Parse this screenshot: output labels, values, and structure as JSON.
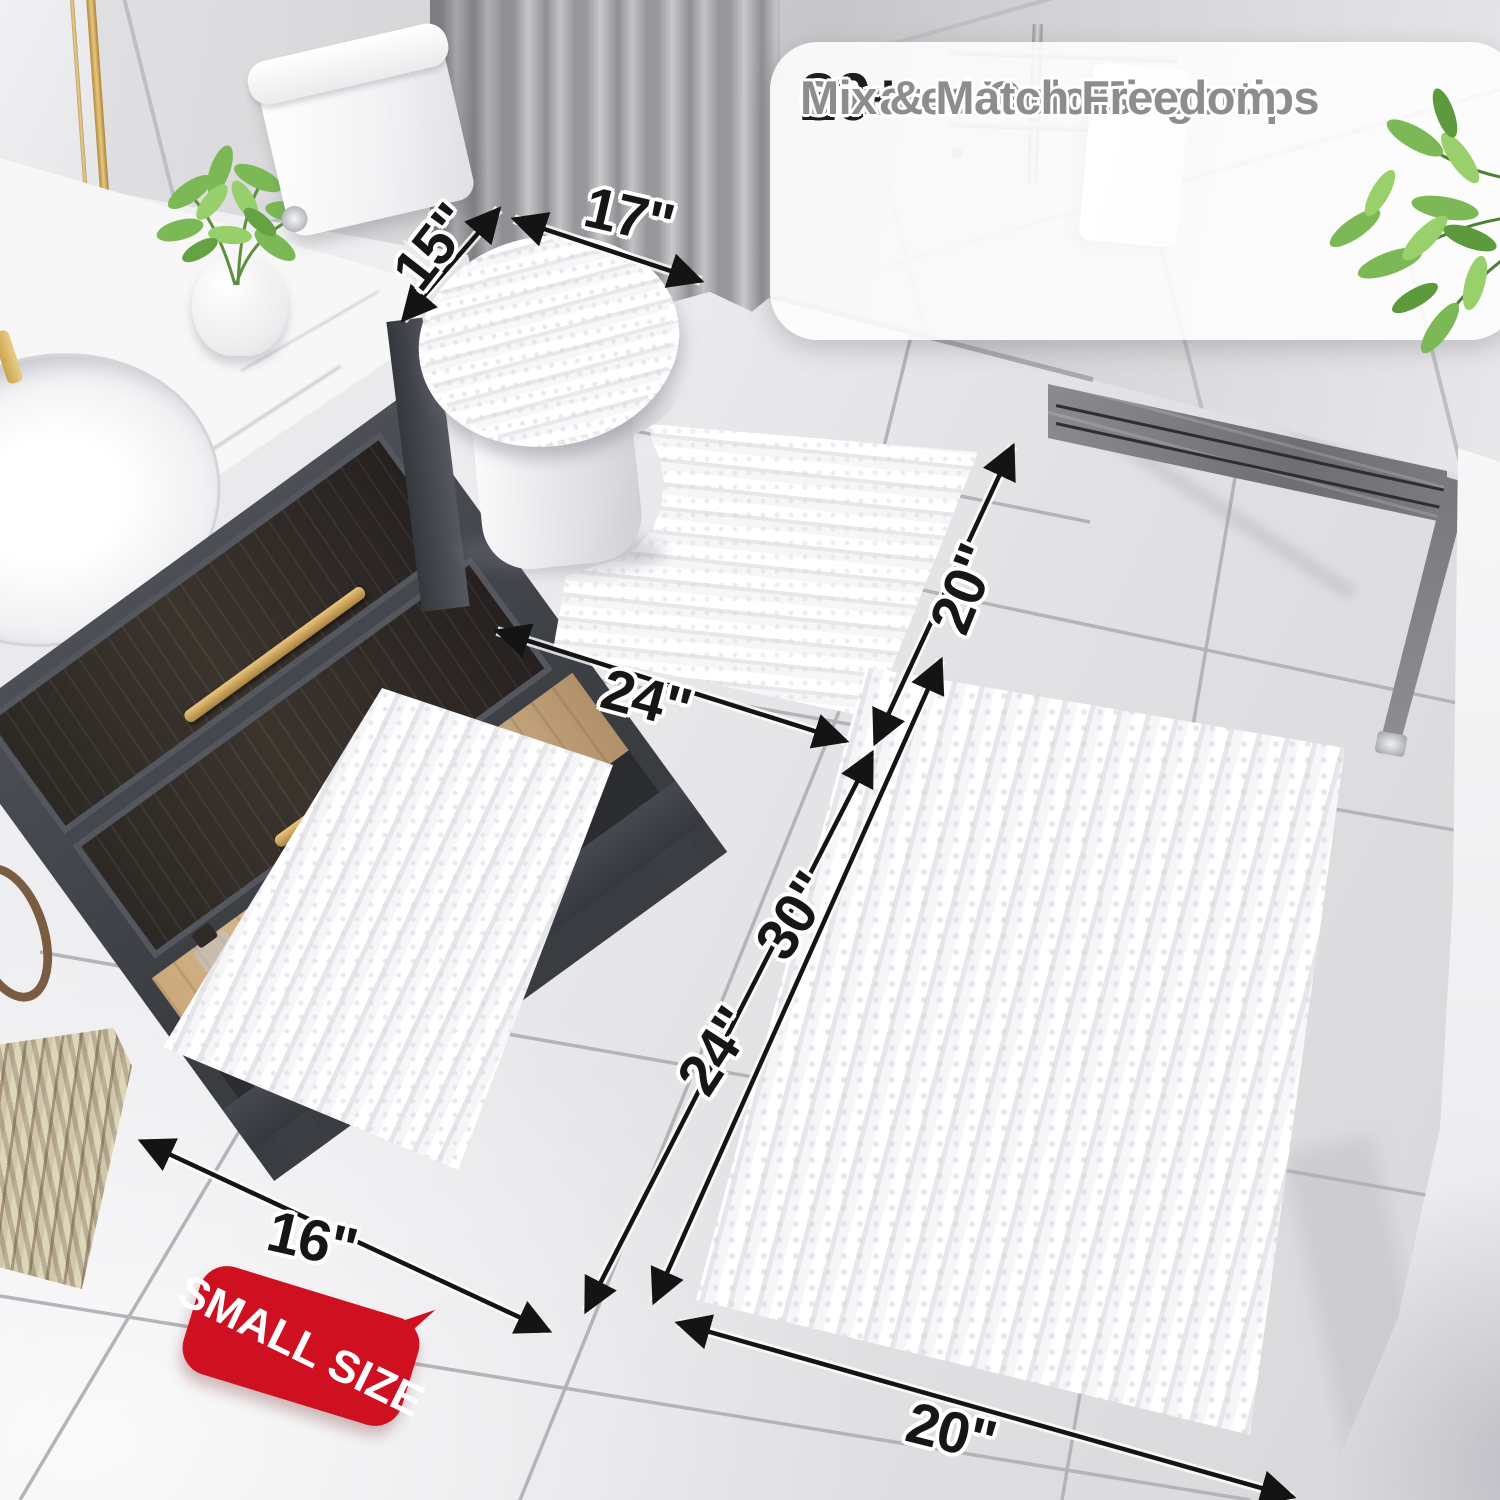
{
  "callout": {
    "checkmark_icon": "✓",
    "items": [
      {
        "stat": "20+",
        "label": "Sizes at Your Fingertips"
      },
      {
        "stat": "30+",
        "label": "Curated Colors"
      },
      {
        "stat": "",
        "label": "Mix & Match Freedom"
      }
    ]
  },
  "dimension_labels": [
    {
      "id": "lid-cover-depth",
      "text": "15\""
    },
    {
      "id": "lid-cover-width",
      "text": "17\""
    },
    {
      "id": "contour-rug-width",
      "text": "24\""
    },
    {
      "id": "contour-rug-depth",
      "text": "20\""
    },
    {
      "id": "large-rug-length",
      "text": "30\""
    },
    {
      "id": "small-rug-length",
      "text": "24\""
    },
    {
      "id": "small-rug-width",
      "text": "16\""
    },
    {
      "id": "large-rug-width",
      "text": "20\""
    }
  ],
  "badge": {
    "text": "SMALL SIZE",
    "color": "#ce1021",
    "text_color": "#ffffff"
  },
  "bottle": {
    "label": "MISQ"
  },
  "colors": {
    "dimension_text": "#161616",
    "feature_text": "#8d8d8f",
    "stat_text": "#1e1e20",
    "check": "#9b9b9d",
    "arrow": "#141414",
    "grout": "#b4b4b8",
    "curb_marble": "#6e6f73",
    "vanity": "#42454b",
    "wood_shelf": "#d3b285",
    "brass_handle": "#c09a5a",
    "leaf_green": "#7cb956",
    "badge_red": "#ce1021"
  }
}
